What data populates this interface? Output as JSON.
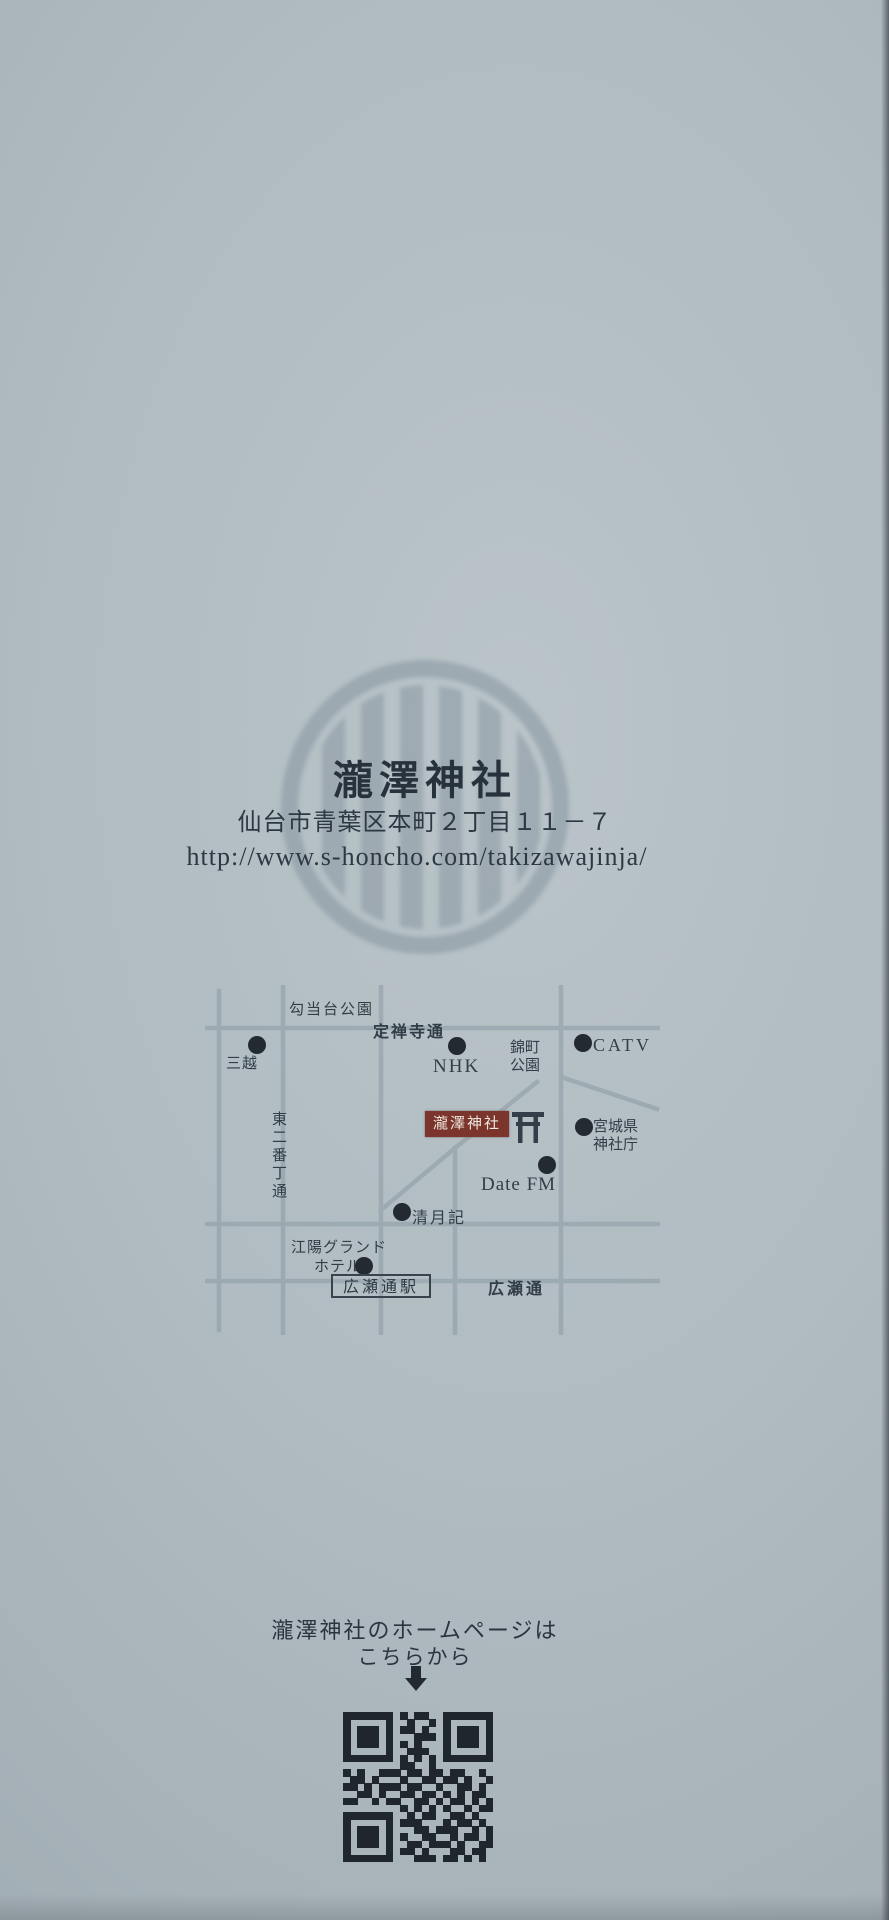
{
  "colors": {
    "paper": "#aeb9bf",
    "ink": "#2d3843",
    "shrine_box": "#7c352c",
    "dot": "#232a31",
    "street": "#8b9aa2"
  },
  "header": {
    "title": "瀧澤神社",
    "address": "仙台市青葉区本町２丁目１１－７",
    "url": "http://www.s-honcho.com/takizawajinja/"
  },
  "map": {
    "street_labels": {
      "koutoudai_park": "勾当台公園",
      "jozenji_dori": "定禅寺通",
      "higashi_nibancho_dori": "東二番丁通",
      "hirose_dori": "広瀬通"
    },
    "landmarks": {
      "mitsukoshi": "三越",
      "nhk": "NHK",
      "nishikimachi_line1": "錦町",
      "nishikimachi_line2": "公園",
      "catv": "CATV",
      "shrine": "瀧澤神社",
      "jinjacho_line1": "宮城県",
      "jinjacho_line2": "神社庁",
      "date_fm": "Date FM",
      "seigetsuki": "清月記",
      "koyo_hotel_line1": "江陽グランド",
      "koyo_hotel_line2": "ホテル",
      "hirose_station": "広瀬通駅"
    }
  },
  "homepage_note": {
    "line1": "瀧澤神社のホームページは",
    "line2": "こちらから"
  },
  "icons": {
    "crest": "shrine-crest-circle-with-stripes",
    "torii": "torii-gate",
    "down_arrow": "down-arrow",
    "qr": "qr-code"
  },
  "qr_code": {
    "matrix": [
      "111111101011001111111",
      "100000100100101000001",
      "101110101101001011101",
      "101110100011101011101",
      "101110101010001011101",
      "100000100111001000001",
      "111111101010101111111",
      "000000001100100000000",
      "101001110110110110010",
      "011010001001101101001",
      "110101110110010011010",
      "001101001101101010110",
      "110010110011010110101",
      "000000001010101001011",
      "111111100101100110100",
      "100000101110001011010",
      "101110100011011100101",
      "101110101001100101101",
      "101110100110111010011",
      "100000101101000110110",
      "111111100011101101010"
    ]
  }
}
